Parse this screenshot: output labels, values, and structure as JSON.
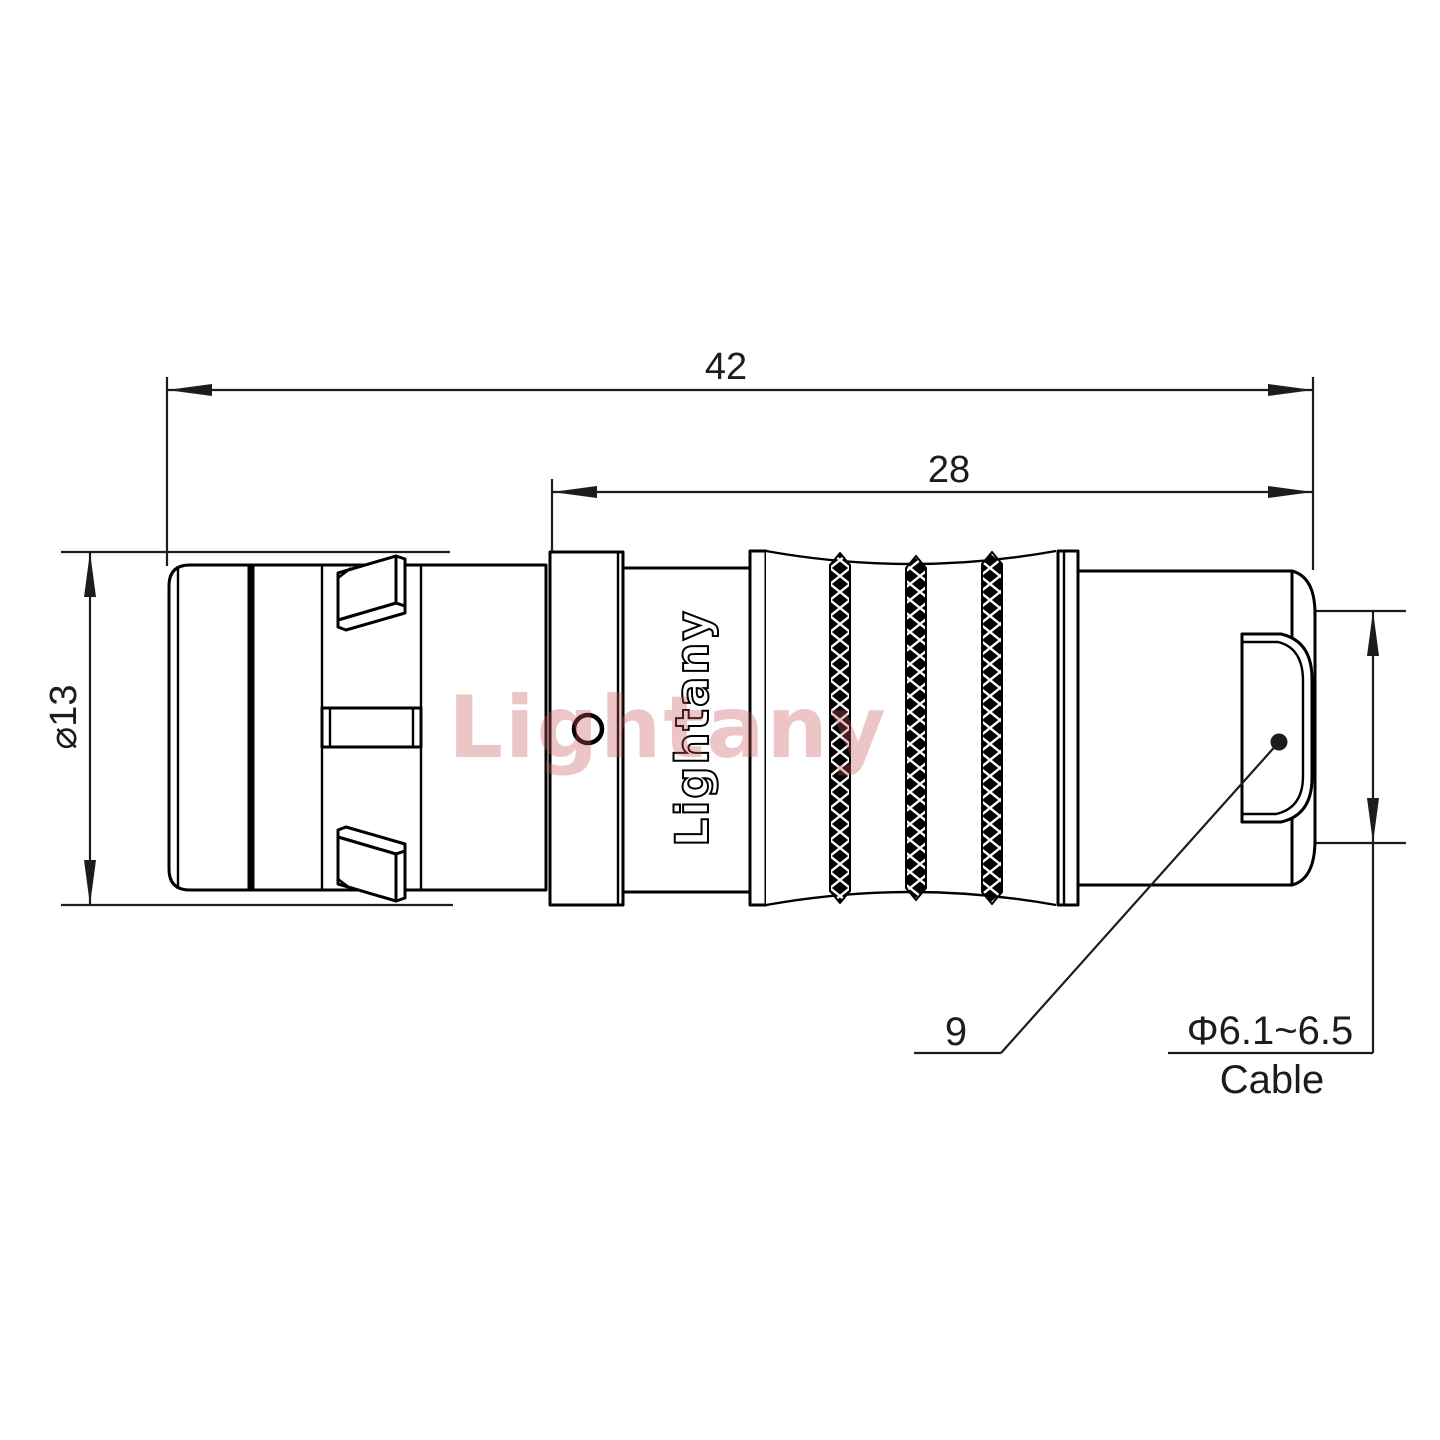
{
  "watermark": {
    "text": "Lightany",
    "color": "rgba(199,88,88,0.34)"
  },
  "part": {
    "body_engraving": "Lightany"
  },
  "dimensions": {
    "overall_length": {
      "value": "42"
    },
    "mid_length": {
      "value": "28"
    },
    "outer_diameter": {
      "value": "⌀13"
    },
    "cable_range": {
      "value": "Φ6.1~6.5",
      "label": "Cable"
    },
    "callout_item": {
      "value": "9"
    }
  },
  "colors": {
    "line": "#000000",
    "text": "#1c1c1c"
  }
}
